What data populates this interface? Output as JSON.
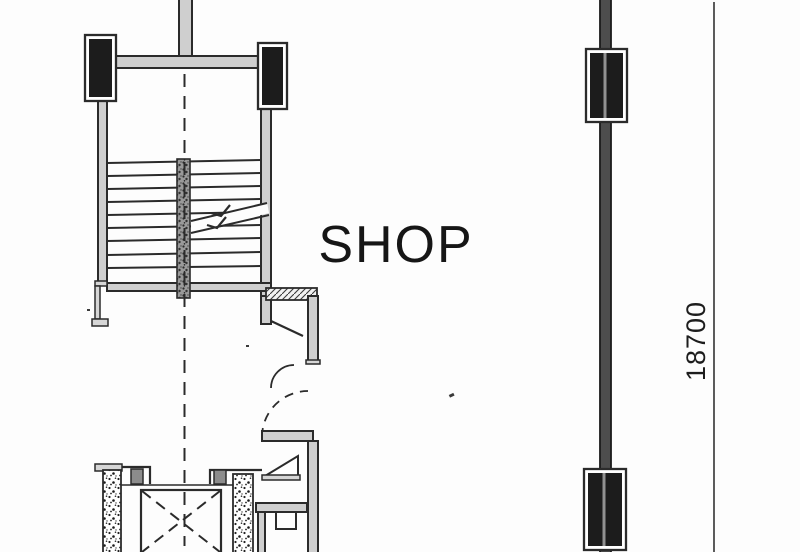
{
  "labels": {
    "room_name": "SHOP",
    "height_dimension": "18700"
  },
  "colors": {
    "paper": "#fdfdfd",
    "ink": "#2b2b2b",
    "column_fill": "#1c1c1c",
    "wall_infill": "#cfcfcf",
    "party_wall_infill": "#4d4d4d"
  }
}
